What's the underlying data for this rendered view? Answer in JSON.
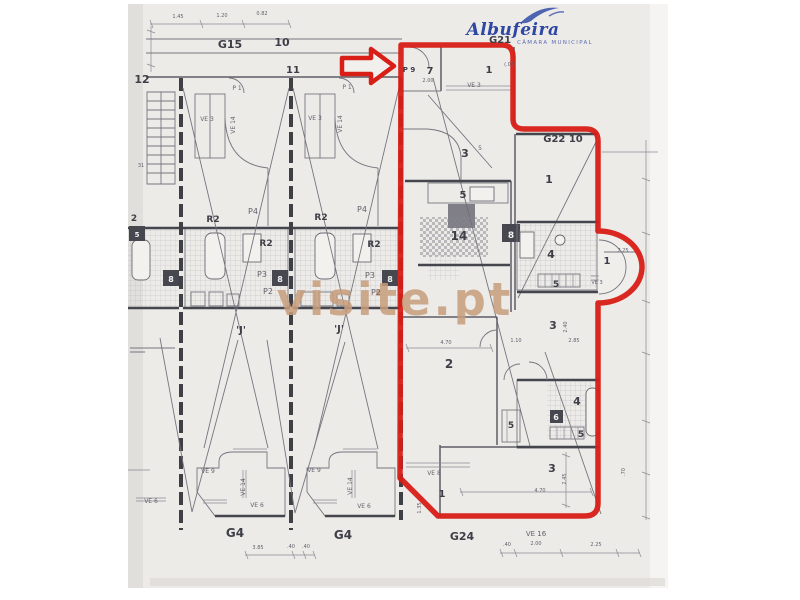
{
  "logo": {
    "name": "Albufeira",
    "subtitle": "CÂMARA MUNICIPAL",
    "color": "#2e47a2",
    "subtitle_color": "#5b6cb4"
  },
  "watermark": {
    "text": "visite.pt",
    "color": "#c89e7d"
  },
  "highlight": {
    "color": "#d81e16"
  },
  "plan": {
    "labels": [
      {
        "t": "1.45",
        "x": 178,
        "y": 18,
        "s": 5,
        "c": "dim"
      },
      {
        "t": "1.20",
        "x": 222,
        "y": 17,
        "s": 5,
        "c": "dim"
      },
      {
        "t": "0.82",
        "x": 262,
        "y": 15,
        "s": 5,
        "c": "dim"
      },
      {
        "t": "G15",
        "x": 230,
        "y": 48,
        "s": 11,
        "c": "room"
      },
      {
        "t": "10",
        "x": 282,
        "y": 46,
        "s": 11,
        "c": "room"
      },
      {
        "t": "11",
        "x": 293,
        "y": 73,
        "s": 10,
        "c": "room"
      },
      {
        "t": "12",
        "x": 142,
        "y": 83,
        "s": 11,
        "c": "room"
      },
      {
        "t": "31",
        "x": 141,
        "y": 167,
        "s": 5,
        "c": "dim"
      },
      {
        "t": "P 1",
        "x": 237,
        "y": 90,
        "s": 6,
        "c": "dim"
      },
      {
        "t": "P 1",
        "x": 347,
        "y": 89,
        "s": 6,
        "c": "dim"
      },
      {
        "t": "VE 3",
        "x": 207,
        "y": 121,
        "s": 6,
        "c": "dim"
      },
      {
        "t": "VE 14",
        "x": 235,
        "y": 125,
        "s": 6,
        "c": "dim",
        "r": -90
      },
      {
        "t": "VE 3",
        "x": 315,
        "y": 120,
        "s": 6,
        "c": "dim"
      },
      {
        "t": "VE 14",
        "x": 342,
        "y": 124,
        "s": 6,
        "c": "dim",
        "r": -90
      },
      {
        "t": "R2",
        "x": 213,
        "y": 222,
        "s": 9,
        "c": "room"
      },
      {
        "t": "R2",
        "x": 321,
        "y": 220,
        "s": 9,
        "c": "room"
      },
      {
        "t": "R2",
        "x": 266,
        "y": 246,
        "s": 9,
        "c": "room"
      },
      {
        "t": "R2",
        "x": 374,
        "y": 247,
        "s": 9,
        "c": "room"
      },
      {
        "t": "2",
        "x": 134,
        "y": 221,
        "s": 9,
        "c": "room"
      },
      {
        "t": "5",
        "x": 137,
        "y": 237,
        "s": 7,
        "c": "white"
      },
      {
        "t": "P4",
        "x": 253,
        "y": 214,
        "s": 8,
        "c": "dim"
      },
      {
        "t": "P4",
        "x": 362,
        "y": 212,
        "s": 8,
        "c": "dim"
      },
      {
        "t": "P3",
        "x": 262,
        "y": 277,
        "s": 8,
        "c": "dim"
      },
      {
        "t": "P3",
        "x": 370,
        "y": 278,
        "s": 8,
        "c": "dim"
      },
      {
        "t": "P2",
        "x": 268,
        "y": 294,
        "s": 8,
        "c": "dim"
      },
      {
        "t": "P2",
        "x": 376,
        "y": 295,
        "s": 8,
        "c": "dim"
      },
      {
        "t": "8",
        "x": 171,
        "y": 282,
        "s": 8,
        "c": "white"
      },
      {
        "t": "8",
        "x": 280,
        "y": 282,
        "s": 8,
        "c": "white"
      },
      {
        "t": "8",
        "x": 390,
        "y": 282,
        "s": 8,
        "c": "white"
      },
      {
        "t": "'J'",
        "x": 241,
        "y": 333,
        "s": 10,
        "c": "room"
      },
      {
        "t": "'J'",
        "x": 339,
        "y": 332,
        "s": 10,
        "c": "room"
      },
      {
        "t": "VE 9",
        "x": 208,
        "y": 473,
        "s": 6,
        "c": "dim"
      },
      {
        "t": "VE 9",
        "x": 314,
        "y": 472,
        "s": 6,
        "c": "dim"
      },
      {
        "t": "VE 14",
        "x": 245,
        "y": 487,
        "s": 6,
        "c": "dim",
        "r": -90
      },
      {
        "t": "VE 14",
        "x": 352,
        "y": 486,
        "s": 6,
        "c": "dim",
        "r": -90
      },
      {
        "t": "VE 6",
        "x": 151,
        "y": 503,
        "s": 6,
        "c": "dim"
      },
      {
        "t": "VE 6",
        "x": 257,
        "y": 507,
        "s": 6,
        "c": "dim"
      },
      {
        "t": "VE 6",
        "x": 364,
        "y": 508,
        "s": 6,
        "c": "dim"
      },
      {
        "t": "G4",
        "x": 235,
        "y": 537,
        "s": 12,
        "c": "room"
      },
      {
        "t": "G4",
        "x": 343,
        "y": 539,
        "s": 12,
        "c": "room"
      },
      {
        "t": "3.85",
        "x": 258,
        "y": 549,
        "s": 5,
        "c": "dim"
      },
      {
        "t": ".40",
        "x": 291,
        "y": 548,
        "s": 5,
        "c": "dim"
      },
      {
        "t": ".40",
        "x": 306,
        "y": 548,
        "s": 5,
        "c": "dim"
      },
      {
        "t": "P 9",
        "x": 409,
        "y": 72,
        "s": 7,
        "c": "room"
      },
      {
        "t": "7",
        "x": 430,
        "y": 74,
        "s": 10,
        "c": "room"
      },
      {
        "t": "2.00",
        "x": 428,
        "y": 82,
        "s": 5,
        "c": "dim"
      },
      {
        "t": "1",
        "x": 489,
        "y": 73,
        "s": 10,
        "c": "room"
      },
      {
        "t": "(.05)",
        "x": 510,
        "y": 66,
        "s": 5,
        "c": "dim"
      },
      {
        "t": "VE 3",
        "x": 474,
        "y": 87,
        "s": 6,
        "c": "dim"
      },
      {
        "t": "G21",
        "x": 500,
        "y": 43,
        "s": 10,
        "c": "room"
      },
      {
        "t": "G22 10",
        "x": 563,
        "y": 142,
        "s": 10,
        "c": "room"
      },
      {
        "t": "3",
        "x": 465,
        "y": 157,
        "s": 11,
        "c": "room"
      },
      {
        "t": "5",
        "x": 480,
        "y": 150,
        "s": 6,
        "c": "dim"
      },
      {
        "t": "1",
        "x": 549,
        "y": 183,
        "s": 11,
        "c": "room"
      },
      {
        "t": "5",
        "x": 463,
        "y": 198,
        "s": 10,
        "c": "room"
      },
      {
        "t": "14",
        "x": 459,
        "y": 240,
        "s": 12,
        "c": "room"
      },
      {
        "t": "8",
        "x": 511,
        "y": 238,
        "s": 9,
        "c": "white"
      },
      {
        "t": "4",
        "x": 551,
        "y": 258,
        "s": 11,
        "c": "room"
      },
      {
        "t": "5",
        "x": 556,
        "y": 287,
        "s": 9,
        "c": "room"
      },
      {
        "t": "1",
        "x": 607,
        "y": 264,
        "s": 10,
        "c": "room"
      },
      {
        "t": "7.25",
        "x": 623,
        "y": 252,
        "s": 5,
        "c": "dim"
      },
      {
        "t": "VE 3",
        "x": 597,
        "y": 284,
        "s": 5,
        "c": "dim"
      },
      {
        "t": "3",
        "x": 553,
        "y": 329,
        "s": 11,
        "c": "room"
      },
      {
        "t": "1.10",
        "x": 516,
        "y": 342,
        "s": 5,
        "c": "dim"
      },
      {
        "t": "2.85",
        "x": 574,
        "y": 342,
        "s": 5,
        "c": "dim"
      },
      {
        "t": "2.40",
        "x": 567,
        "y": 327,
        "s": 5,
        "c": "dim",
        "r": -90
      },
      {
        "t": "4.70",
        "x": 446,
        "y": 344,
        "s": 5,
        "c": "dim"
      },
      {
        "t": "2",
        "x": 449,
        "y": 368,
        "s": 12,
        "c": "room"
      },
      {
        "t": "5",
        "x": 511,
        "y": 428,
        "s": 9,
        "c": "room"
      },
      {
        "t": "6",
        "x": 556,
        "y": 420,
        "s": 8,
        "c": "white"
      },
      {
        "t": "4",
        "x": 577,
        "y": 405,
        "s": 11,
        "c": "room"
      },
      {
        "t": "5",
        "x": 581,
        "y": 437,
        "s": 9,
        "c": "room"
      },
      {
        "t": "3",
        "x": 552,
        "y": 472,
        "s": 11,
        "c": "room"
      },
      {
        "t": "VE 8",
        "x": 434,
        "y": 475,
        "s": 6,
        "c": "dim"
      },
      {
        "t": "1",
        "x": 442,
        "y": 497,
        "s": 10,
        "c": "room"
      },
      {
        "t": "1.35",
        "x": 421,
        "y": 508,
        "s": 5,
        "c": "dim",
        "r": -90
      },
      {
        "t": "4.70",
        "x": 540,
        "y": 492,
        "s": 5,
        "c": "dim"
      },
      {
        "t": "2.45",
        "x": 566,
        "y": 479,
        "s": 5,
        "c": "dim",
        "r": -90
      },
      {
        "t": "G24",
        "x": 462,
        "y": 540,
        "s": 11,
        "c": "room"
      },
      {
        "t": "VE 16",
        "x": 536,
        "y": 536,
        "s": 7,
        "c": "dim"
      },
      {
        "t": ".40",
        "x": 507,
        "y": 546,
        "s": 5,
        "c": "dim"
      },
      {
        "t": "2.00",
        "x": 536,
        "y": 545,
        "s": 5,
        "c": "dim"
      },
      {
        "t": "2.25",
        "x": 596,
        "y": 546,
        "s": 5,
        "c": "dim"
      },
      {
        "t": ".70",
        "x": 625,
        "y": 472,
        "s": 5,
        "c": "dim",
        "r": -90
      }
    ]
  }
}
